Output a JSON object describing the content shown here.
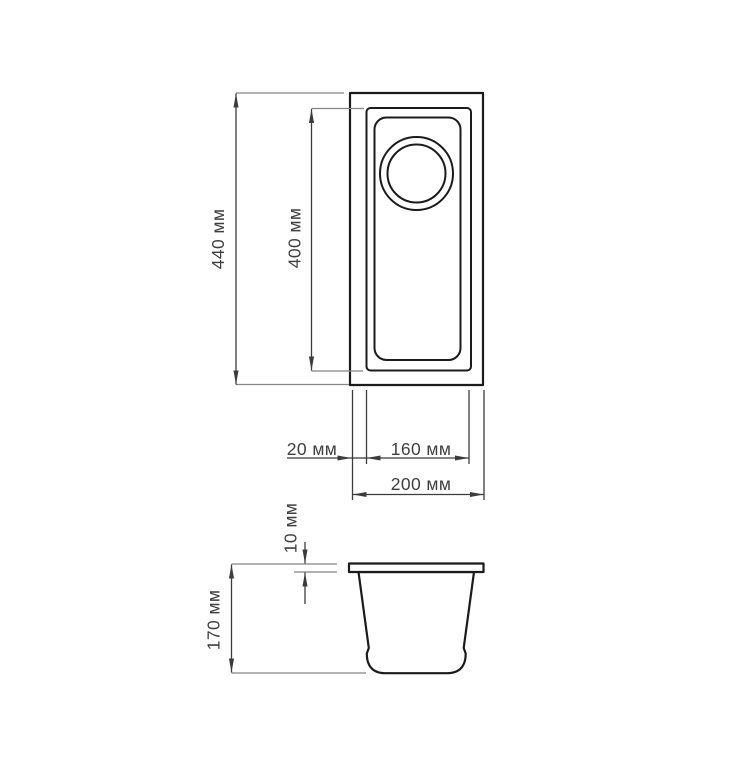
{
  "diagram": {
    "type": "technical-drawing",
    "subject": "rectangular undermount sink with round drain, top view and side view",
    "unit": "мм",
    "views": [
      {
        "id": "top-view",
        "dimensions": [
          {
            "id": "outer-height",
            "label": "440 мм",
            "value": 440,
            "measures": "overall outer length"
          },
          {
            "id": "basin-height",
            "label": "400 мм",
            "value": 400,
            "measures": "inner bowl length"
          },
          {
            "id": "edge-offset",
            "label": "20 мм",
            "value": 20,
            "measures": "rim offset from outer edge to bowl"
          },
          {
            "id": "basin-width",
            "label": "160 мм",
            "value": 160,
            "measures": "inner bowl width"
          },
          {
            "id": "outer-width",
            "label": "200 мм",
            "value": 200,
            "measures": "overall outer width"
          }
        ]
      },
      {
        "id": "side-view",
        "dimensions": [
          {
            "id": "rim-thickness",
            "label": "10 мм",
            "value": 10,
            "measures": "rim / flange thickness"
          },
          {
            "id": "total-height",
            "label": "170 мм",
            "value": 170,
            "measures": "overall bowl depth"
          }
        ]
      }
    ],
    "colors": {
      "background": "#ffffff",
      "outline": "#1b1b1b",
      "dimension_line": "#3c3c3c",
      "extension_line": "#858585",
      "label_text": "#3f3f3f"
    }
  }
}
